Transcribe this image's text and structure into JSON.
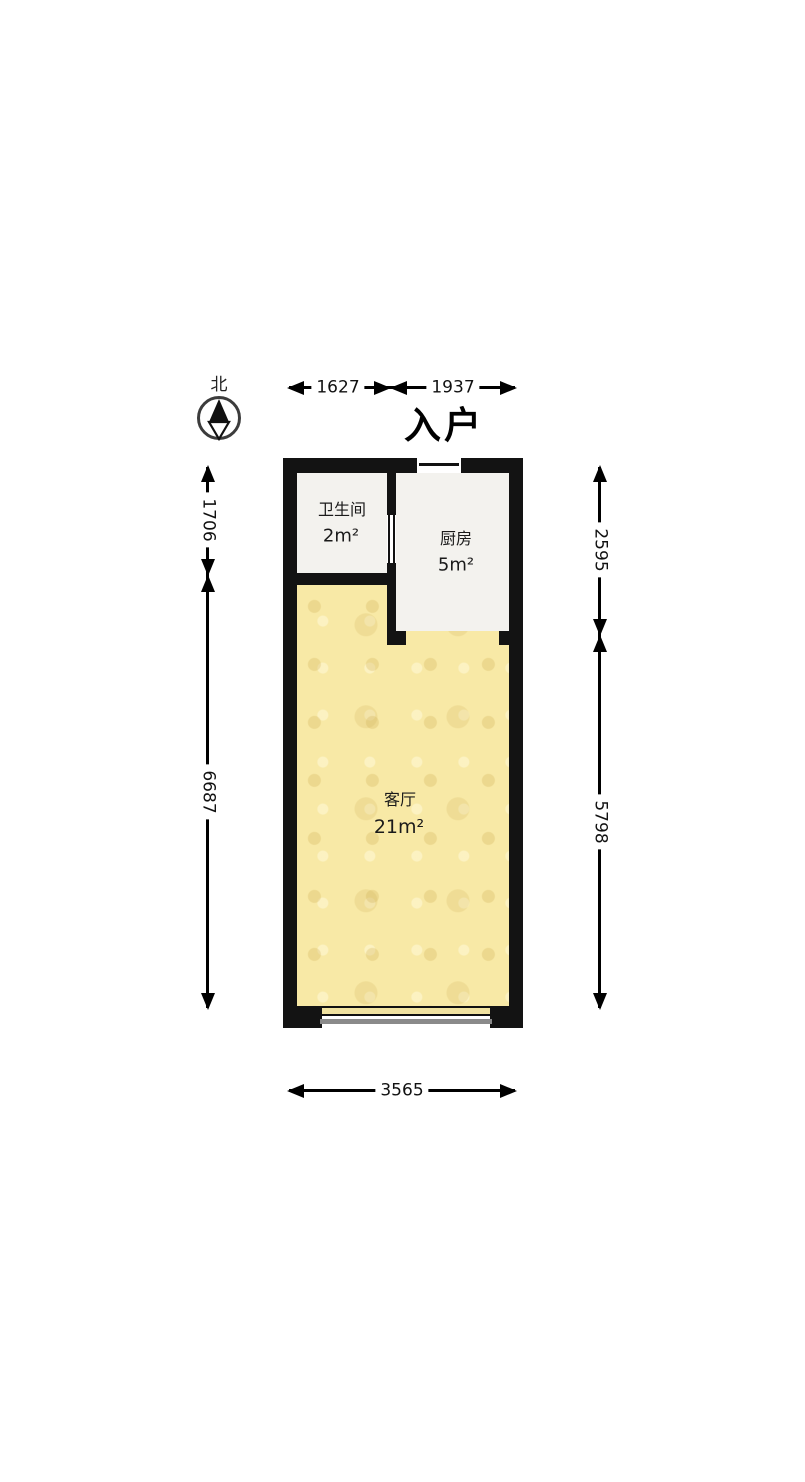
{
  "compass": {
    "north_label": "北"
  },
  "entrance_label": "入户",
  "rooms": {
    "bathroom": {
      "name": "卫生间",
      "area": "2m²"
    },
    "kitchen": {
      "name": "厨房",
      "area": "5m²"
    },
    "living": {
      "name": "客厅",
      "area": "21m²"
    }
  },
  "dimensions": {
    "top_left": "1627",
    "top_right": "1937",
    "left_upper": "1706",
    "left_lower": "6687",
    "right_upper": "2595",
    "right_lower": "5798",
    "bottom": "3565"
  },
  "colors": {
    "wall": "#131313",
    "living_floor": "#f8e9a6",
    "wet_floor": "#f3f2ee",
    "window_shadow": "#8a8a8a",
    "dimension_line": "#000000"
  }
}
